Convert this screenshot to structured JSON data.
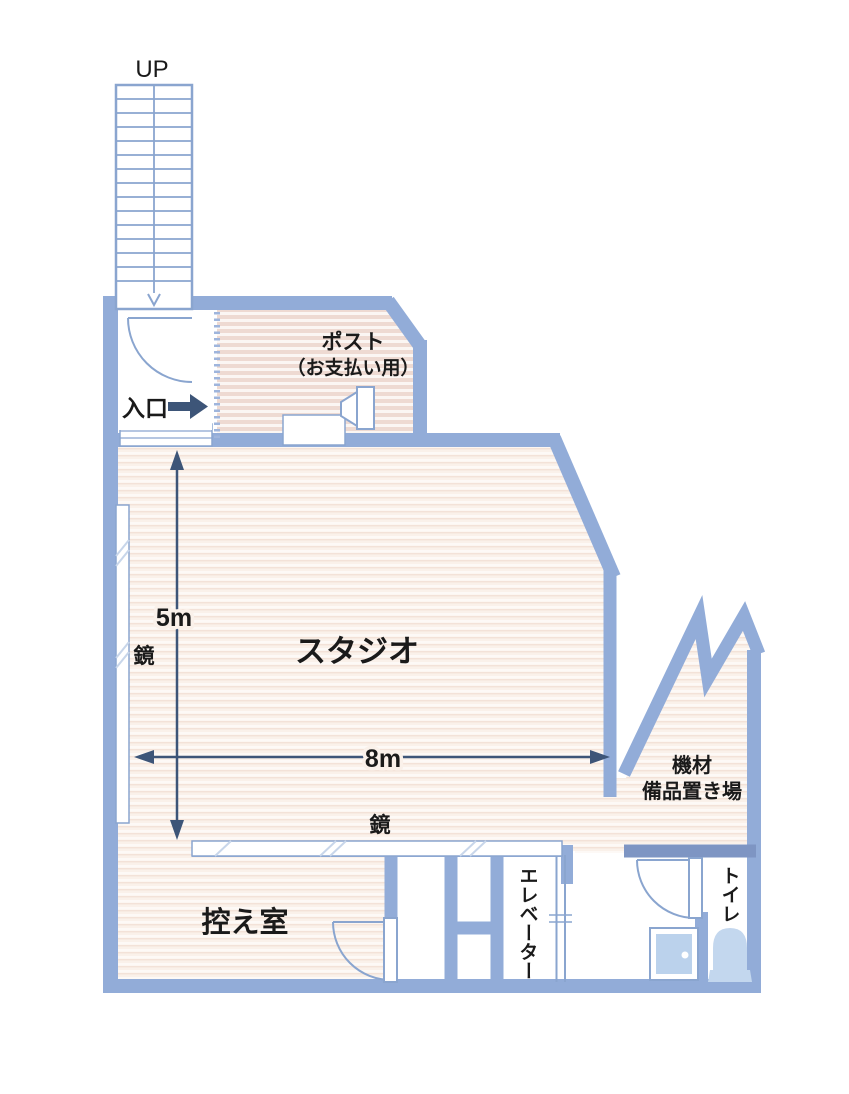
{
  "title": "studio-floor-plan",
  "labels": {
    "up": "UP",
    "entrance": "入口",
    "post_line1": "ポスト",
    "post_line2": "（お支払い用）",
    "studio": "スタジオ",
    "mirror_left": "鏡",
    "mirror_bottom": "鏡",
    "dim_height": "5m",
    "dim_width": "8m",
    "equipment_line1": "機材",
    "equipment_line2": "備品置き場",
    "waiting_room": "控え室",
    "elevator": "エレベーター",
    "toilet": "トイレ"
  },
  "dimensions": {
    "studio_width": "8m",
    "studio_height": "5m"
  },
  "colors": {
    "wall": "#92ACD8",
    "wall_dark": "#7E95C3",
    "wall_outline": "#8AA5CF",
    "floor_warm": "#FAF1EA",
    "floor_warm_stripe": "#F3E2D8",
    "floor_pink": "#EEDAD2",
    "arrow": "#3D5578",
    "fixture_blue": "#C3D7EE",
    "text": "#1A1A1A"
  }
}
